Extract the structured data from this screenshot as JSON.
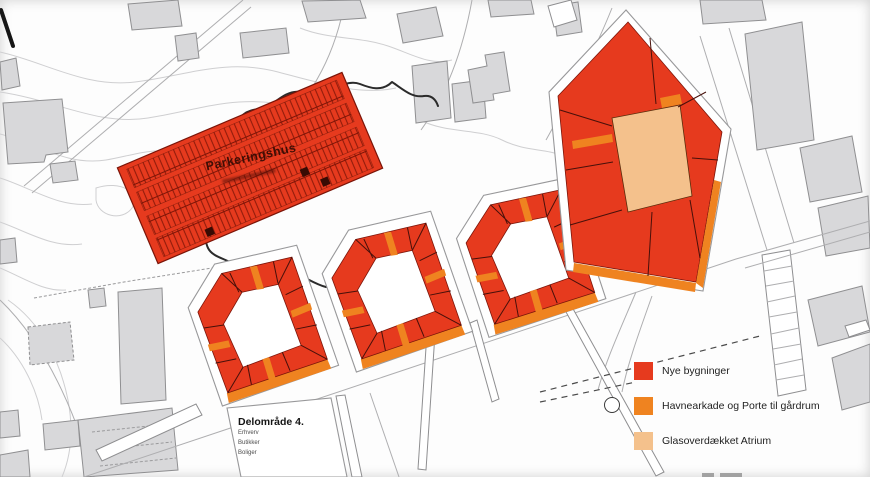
{
  "colors": {
    "red": "#e63a1e",
    "orange": "#ef8320",
    "peach": "#f4c18c",
    "building-fill": "#d8d8da",
    "building-stroke": "#8f8f91",
    "contour": "#cfcfd1",
    "road-line": "#aeaeb0",
    "terrain-line": "#2b2b2b",
    "divider": "#47100a",
    "text-dark": "#1c1c1c"
  },
  "map": {
    "parking_label": "Parkeringshus",
    "area_box": {
      "title": "Delområde 4.",
      "lines": [
        "Erhverv",
        "Butikker",
        "Boliger"
      ]
    }
  },
  "legend": {
    "items": [
      {
        "id": "nye-bygninger",
        "symbol": "square",
        "color": "#e63a1e",
        "label": "Nye bygninger"
      },
      {
        "id": "havnearkade",
        "symbol": "square",
        "color": "#ef8320",
        "label": "Havnearkade og Porte til gårdrum"
      },
      {
        "id": "atrium",
        "symbol": "square",
        "color": "#f4c18c",
        "label": "Glasoverdækket Atrium"
      }
    ],
    "porte_symbol": "circle"
  }
}
